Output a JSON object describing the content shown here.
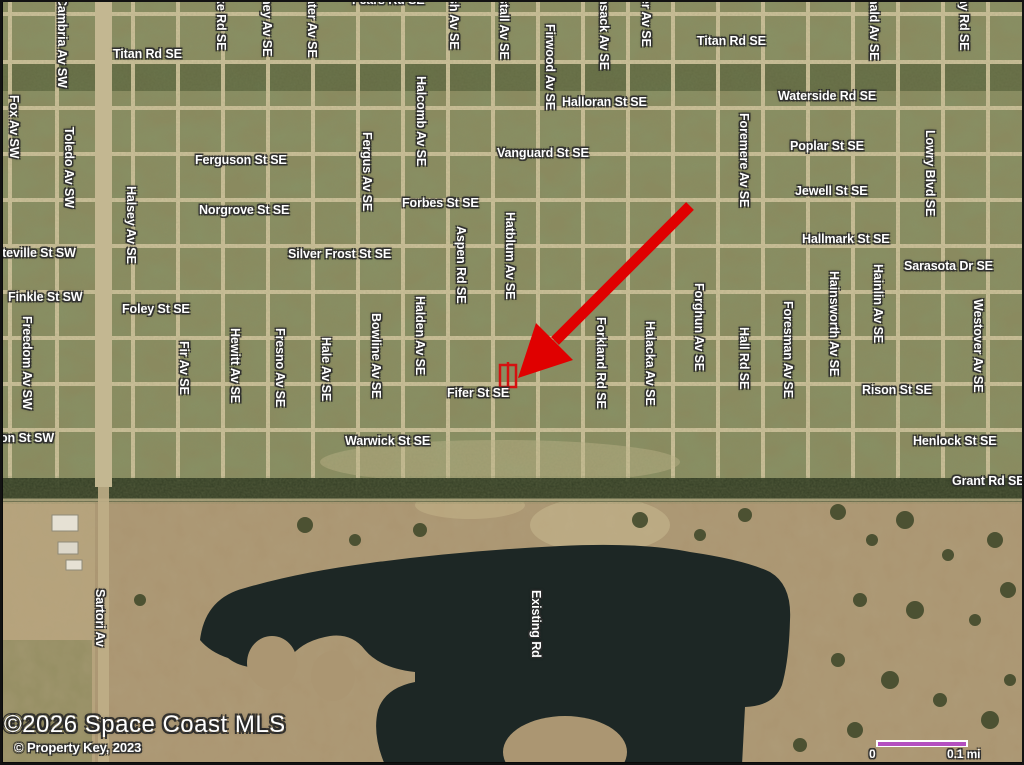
{
  "map": {
    "type": "aerial-satellite",
    "attribution": {
      "line1": "©2026 Space Coast MLS",
      "line2": "© Property Key, 2023"
    },
    "scale_bar": {
      "start_label": "0",
      "end_label": "0.1 mi",
      "bar_color": "#b44fc0"
    },
    "annotation": {
      "arrow_color": "#e00000",
      "parcel_marker_color": "#d51111",
      "points_to": "Fifer St SE"
    },
    "colors": {
      "urban_base": "#8b8a5f",
      "pasture": "#ab9672",
      "pasture_left": "#b6a37c",
      "lake": "#1d2725",
      "road": "#cdc19a",
      "hedge": "#2f3a22",
      "label_text": "#ffffff"
    },
    "water_label": "Existing Rd",
    "street_labels_horizontal": [
      {
        "t": "Titan Rd SE",
        "x": 113,
        "y": 47
      },
      {
        "t": "Fears Rd SE",
        "x": 352,
        "y": -7
      },
      {
        "t": "Titan Rd SE",
        "x": 697,
        "y": 34
      },
      {
        "t": "Waterside Rd SE",
        "x": 778,
        "y": 89
      },
      {
        "t": "Halloran St SE",
        "x": 562,
        "y": 95
      },
      {
        "t": "Vanguard St SE",
        "x": 497,
        "y": 146
      },
      {
        "t": "Poplar St SE",
        "x": 790,
        "y": 139
      },
      {
        "t": "Ferguson St SE",
        "x": 195,
        "y": 153
      },
      {
        "t": "Jewell St SE",
        "x": 795,
        "y": 184
      },
      {
        "t": "Norgrove St SE",
        "x": 199,
        "y": 203
      },
      {
        "t": "Forbes St SE",
        "x": 402,
        "y": 196
      },
      {
        "t": "Hallmark St SE",
        "x": 802,
        "y": 232
      },
      {
        "t": "tteville St SW",
        "x": -2,
        "y": 246
      },
      {
        "t": "Silver Frost St SE",
        "x": 288,
        "y": 247
      },
      {
        "t": "Sarasota Dr SE",
        "x": 904,
        "y": 259
      },
      {
        "t": "Finkle St SW",
        "x": 8,
        "y": 290
      },
      {
        "t": "Foley St SE",
        "x": 122,
        "y": 302
      },
      {
        "t": "Fifer St SE",
        "x": 447,
        "y": 386
      },
      {
        "t": "Rison St SE",
        "x": 862,
        "y": 383
      },
      {
        "t": "on St SW",
        "x": 0,
        "y": 431
      },
      {
        "t": "Warwick St SE",
        "x": 345,
        "y": 434
      },
      {
        "t": "Henlock St SE",
        "x": 913,
        "y": 434
      },
      {
        "t": "Grant Rd SE",
        "x": 952,
        "y": 474
      }
    ],
    "street_labels_vertical": [
      {
        "t": "Cambria Av SW",
        "x": 69,
        "y": -3
      },
      {
        "t": "ke Rd SE",
        "x": 228,
        "y": -3
      },
      {
        "t": "ney Av SE",
        "x": 274,
        "y": -3
      },
      {
        "t": "ater Av SE",
        "x": 319,
        "y": -3
      },
      {
        "t": "sh Av SE",
        "x": 461,
        "y": -3
      },
      {
        "t": "stall Av SE",
        "x": 511,
        "y": -3
      },
      {
        "t": "nsack Av SE",
        "x": 611,
        "y": -3
      },
      {
        "t": "er Av SE",
        "x": 653,
        "y": -3
      },
      {
        "t": "nald Av SE",
        "x": 881,
        "y": -3
      },
      {
        "t": "ay Rd SE",
        "x": 971,
        "y": -3
      },
      {
        "t": "Fox Av SW",
        "x": 21,
        "y": 95
      },
      {
        "t": "Toledo Av SW",
        "x": 76,
        "y": 127
      },
      {
        "t": "Firwood Av SE",
        "x": 557,
        "y": 24
      },
      {
        "t": "Halcomb Av SE",
        "x": 428,
        "y": 76
      },
      {
        "t": "Foremere Av SE",
        "x": 751,
        "y": 113
      },
      {
        "t": "Lowry Blvd SE",
        "x": 937,
        "y": 130
      },
      {
        "t": "Fergus Av SE",
        "x": 374,
        "y": 132
      },
      {
        "t": "Halsey Av SE",
        "x": 138,
        "y": 186
      },
      {
        "t": "Hatblum Av SE",
        "x": 517,
        "y": 212
      },
      {
        "t": "Aspen Rd SE",
        "x": 468,
        "y": 226
      },
      {
        "t": "Hainlin Av SE",
        "x": 885,
        "y": 264
      },
      {
        "t": "Hainsworth Av SE",
        "x": 841,
        "y": 271
      },
      {
        "t": "Forghun Av SE",
        "x": 706,
        "y": 283
      },
      {
        "t": "Westover Av SE",
        "x": 985,
        "y": 299
      },
      {
        "t": "Foresman Av SE",
        "x": 795,
        "y": 301
      },
      {
        "t": "Bowline Av SE",
        "x": 383,
        "y": 313
      },
      {
        "t": "Halden Av SE",
        "x": 427,
        "y": 296
      },
      {
        "t": "Freedom Av SW",
        "x": 34,
        "y": 316
      },
      {
        "t": "Forkland Rd SE",
        "x": 608,
        "y": 317
      },
      {
        "t": "Halacka Av SE",
        "x": 657,
        "y": 321
      },
      {
        "t": "Hall Rd SE",
        "x": 751,
        "y": 327
      },
      {
        "t": "Fir Av SE",
        "x": 191,
        "y": 341
      },
      {
        "t": "Hewitt Av SE",
        "x": 242,
        "y": 328
      },
      {
        "t": "Fresno Av SE",
        "x": 287,
        "y": 328
      },
      {
        "t": "Hale Av SE",
        "x": 333,
        "y": 337
      },
      {
        "t": "Sartori Av",
        "x": 107,
        "y": 589
      },
      {
        "t": "Existing Rd",
        "x": 543,
        "y": 590
      }
    ]
  }
}
